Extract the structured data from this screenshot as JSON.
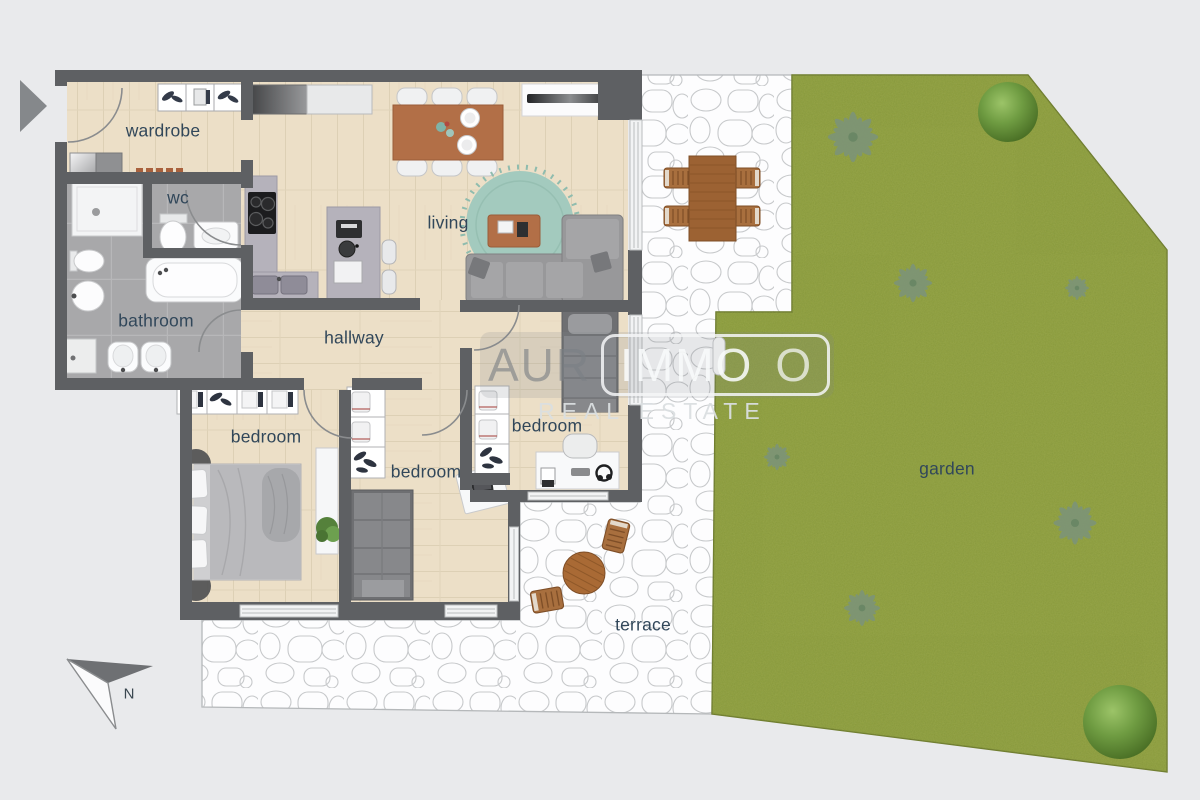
{
  "page": {
    "background": "#e9eaec"
  },
  "labels": {
    "wardrobe": "wardrobe",
    "wc": "wc",
    "bathroom": "bathroom",
    "hallway": "hallway",
    "living": "living",
    "bedroom1": "bedroom",
    "bedroom2": "bedroom",
    "bedroom3": "bedroom",
    "garden": "garden",
    "terrace": "terrace"
  },
  "watermark": {
    "brand_left": "AUR",
    "brand_boxed": "IMMO",
    "brand_suffix": "O",
    "tagline": "REAL ESTATE"
  },
  "compass": {
    "label": "N"
  },
  "colors": {
    "wall": "#5e6063",
    "wood_floor": "#ecdfc7",
    "tile_floor": "#a8a8aa",
    "garden_green": "#8d9d3c",
    "terrace_stone": "#fdfdfe",
    "rug_teal": "#a3cabe",
    "table_brown": "#b26f47",
    "outdoor_brown": "#a86f3e",
    "label_text": "#31475a"
  }
}
